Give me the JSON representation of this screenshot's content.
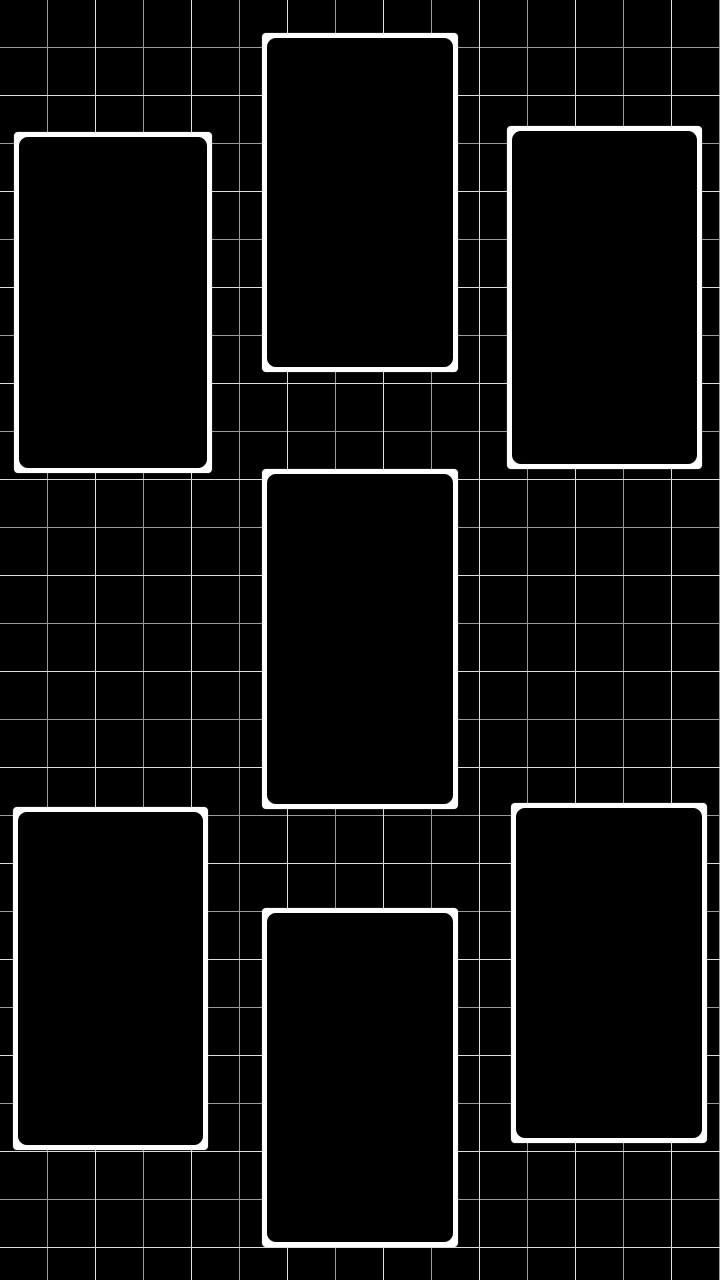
{
  "wallpaper": {
    "background_color": "#000000",
    "grid": {
      "cell_size_px": 48,
      "line_width_px": 1,
      "line_color": "#9a9a9a",
      "bright_line_color": "#dcdcdc"
    },
    "frame_style": {
      "border_color": "#ffffff",
      "fill_color": "#000000",
      "border_width_px": 5,
      "outer_corner_radius_px": 4,
      "inner_corner_radius_px": 9
    },
    "frame_count": 7,
    "frames": [
      {
        "id": "photo-frame-top-left",
        "x": 14,
        "y": 132,
        "width": 198,
        "height": 341
      },
      {
        "id": "photo-frame-top-center",
        "x": 262,
        "y": 33,
        "width": 196,
        "height": 339
      },
      {
        "id": "photo-frame-top-right",
        "x": 507,
        "y": 126,
        "width": 195,
        "height": 343
      },
      {
        "id": "photo-frame-middle-center",
        "x": 262,
        "y": 469,
        "width": 196,
        "height": 340
      },
      {
        "id": "photo-frame-bottom-left",
        "x": 13,
        "y": 807,
        "width": 195,
        "height": 343
      },
      {
        "id": "photo-frame-bottom-center",
        "x": 262,
        "y": 908,
        "width": 196,
        "height": 339
      },
      {
        "id": "photo-frame-bottom-right",
        "x": 511,
        "y": 803,
        "width": 196,
        "height": 340
      }
    ]
  }
}
